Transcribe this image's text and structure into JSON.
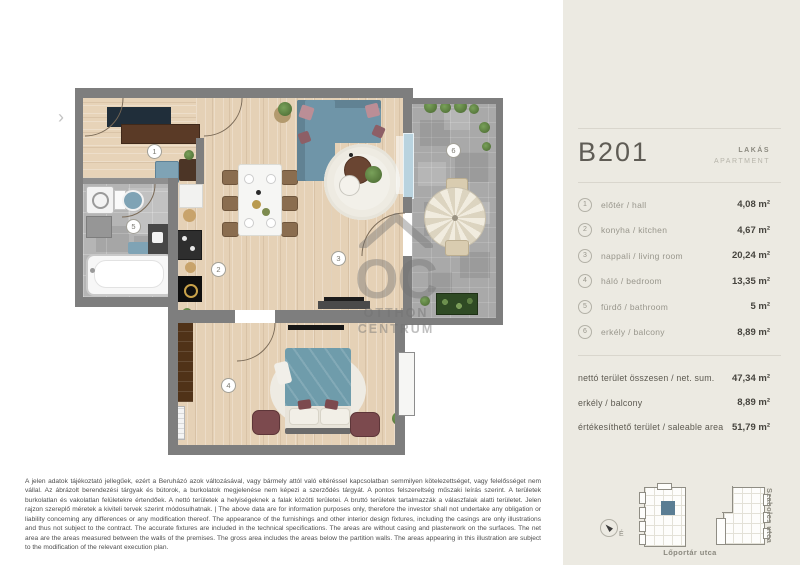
{
  "plan": {
    "entrance_marker": "›",
    "badges": {
      "hall": "1",
      "kitchen": "2",
      "living": "3",
      "bedroom": "4",
      "bath": "5",
      "balcony": "6"
    },
    "watermark": {
      "logo": "OC",
      "line1": "OTTHON",
      "line2": "CENTRUM"
    }
  },
  "sidebar": {
    "unit_id": "B201",
    "unit_type_hu": "LAKÁS",
    "unit_type_en": "APARTMENT",
    "rooms": [
      {
        "num": "1",
        "label": "előtér / hall",
        "area": "4,08 m²"
      },
      {
        "num": "2",
        "label": "konyha / kitchen",
        "area": "4,67 m²"
      },
      {
        "num": "3",
        "label": "nappali / living room",
        "area": "20,24 m²"
      },
      {
        "num": "4",
        "label": "háló / bedroom",
        "area": "13,35 m²"
      },
      {
        "num": "5",
        "label": "fürdő / bathroom",
        "area": "5 m²"
      },
      {
        "num": "6",
        "label": "erkély / balcony",
        "area": "8,89 m²"
      }
    ],
    "totals": [
      {
        "label": "nettó terület összesen / net. sum.",
        "value": "47,34 m²"
      },
      {
        "label": "erkély / balcony",
        "value": "8,89 m²"
      },
      {
        "label": "értékesíthető terület / saleable area",
        "value": "51,79 m²"
      }
    ],
    "siteplan": {
      "north_label": "É",
      "street_bottom": "Lőportár utca",
      "street_right": "Szabolcs utca"
    }
  },
  "colors": {
    "highlight_unit": "#5a7d93",
    "sidebar_bg": "#eceae2"
  },
  "disclaimer": "A jelen adatok tájékoztató jellegűek, ezért a Beruházó azok változásával, vagy bármely attól való eltéréssel kapcsolatban semmilyen kötelezettséget, vagy felelősséget nem vállal. Az ábrázolt berendezési tárgyak és bútorok, a burkolatok megjelenése nem képezi a szerződés tárgyát. A pontos felszereltség műszaki leírás szerint. A területek burkolatlan és vakolatlan felületekre értendőek. A nettó területek a helyiségeknek a falak közötti területei. A bruttó területek tartalmazzák a válaszfalak alatti területet. Jelen rajzon szereplő méretek a kiviteli tervek szerint módosulhatnak. | The above data are for information purposes only, therefore the investor shall not undertake any obligation or liability concerning any differences or any modification thereof. The appearance of the furnishings and other interior design fixtures, including the casings are only illustrations and thus not subject to the contract. The accurate fixtures are included in the technical specifications. The areas are without casing and plasterwork on the surfaces. The net area are the areas measured between the walls of the premises. The gross area includes the areas below the partition walls. The areas appearing in this illustration are subject to the modification of the relevant execution plan."
}
